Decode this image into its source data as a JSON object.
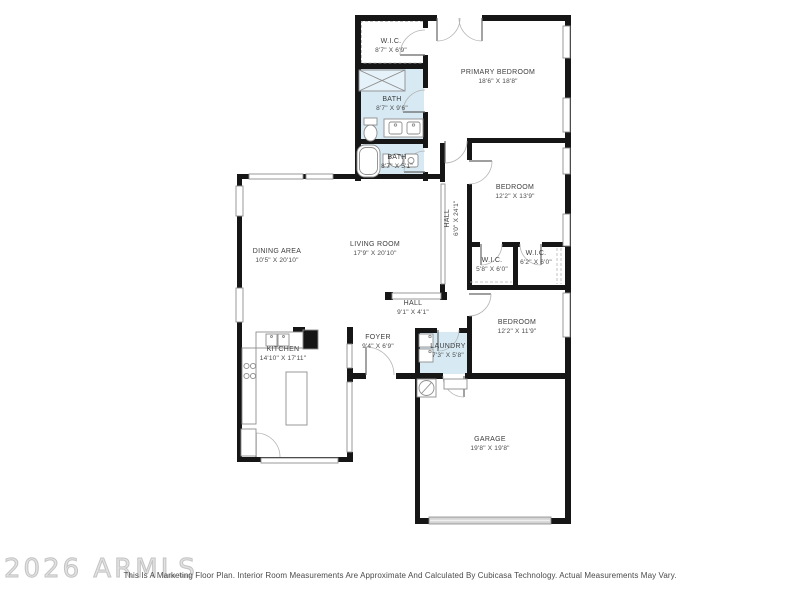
{
  "colors": {
    "wall": "#161616",
    "wet_room_fill": "#d7eaf4",
    "window_line": "#8e8e8e",
    "door_arc": "#b5b5b5",
    "label_text": "#3d3d3d",
    "garage_door": "#d4d4d4",
    "watermark": "#c9c9c9",
    "disclaimer_text": "#4a4a4a"
  },
  "rooms": [
    {
      "id": "wic-top",
      "name": "W.I.C.",
      "dims": "8'7\" X 6'9\""
    },
    {
      "id": "primary-bedroom",
      "name": "PRIMARY BEDROOM",
      "dims": "18'6\" X 18'8\""
    },
    {
      "id": "bath-primary",
      "name": "BATH",
      "dims": "8'7\" X 9'6\""
    },
    {
      "id": "bath-hall",
      "name": "BATH",
      "dims": "8'7\" X 5'1\""
    },
    {
      "id": "bedroom-upper",
      "name": "BEDROOM",
      "dims": "12'2\" X 13'9\""
    },
    {
      "id": "hall-long",
      "name": "HALL",
      "dims": "6'0\" X 24'1\""
    },
    {
      "id": "dining-area",
      "name": "DINING AREA",
      "dims": "10'5\" X 20'10\""
    },
    {
      "id": "living-room",
      "name": "LIVING ROOM",
      "dims": "17'9\" X 20'10\""
    },
    {
      "id": "wic-left",
      "name": "W.I.C.",
      "dims": "5'8\" X 6'0\""
    },
    {
      "id": "wic-right",
      "name": "W.I.C.",
      "dims": "6'2\" X 6'0\""
    },
    {
      "id": "bedroom-lower",
      "name": "BEDROOM",
      "dims": "12'2\" X 11'9\""
    },
    {
      "id": "hall-short",
      "name": "HALL",
      "dims": "9'1\" X 4'1\""
    },
    {
      "id": "kitchen",
      "name": "KITCHEN",
      "dims": "14'10\" X 17'11\""
    },
    {
      "id": "foyer",
      "name": "FOYER",
      "dims": "9'4\" X 6'9\""
    },
    {
      "id": "laundry",
      "name": "LAUNDRY",
      "dims": "7'3\" X 5'8\""
    },
    {
      "id": "garage",
      "name": "GARAGE",
      "dims": "19'8\" X 19'8\""
    }
  ],
  "footer": {
    "watermark": "2026 ARMLS",
    "disclaimer": "This Is A Marketing Floor Plan. Interior Room Measurements Are Approximate And Calculated By Cubicasa Technology. Actual Measurements May Vary."
  }
}
